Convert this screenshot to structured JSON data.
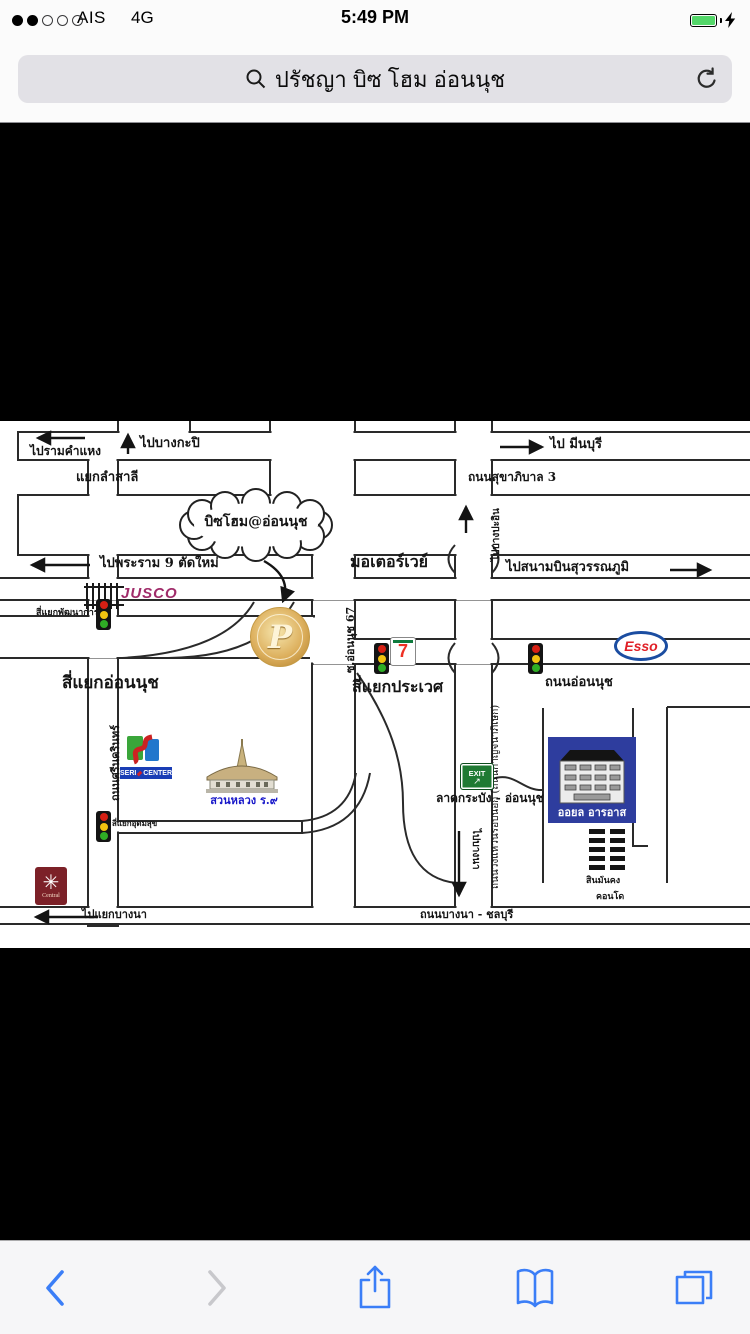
{
  "status_bar": {
    "carrier": "AIS",
    "network": "4G",
    "time": "5:49 PM"
  },
  "address_bar": {
    "query": "ปรัชญา บิซ โฮม อ่อนนุช"
  },
  "map": {
    "cloud_label": "บิซโฮม@อ่อนนุช",
    "coin_letter": "P",
    "directions": {
      "to_ramkhamhaeng": "ไปรามคำแหง",
      "to_bangkapi": "ไปบางกะปิ",
      "to_minburi": "ไป มีนบุรี",
      "to_rama9": "ไปพระราม 9 ตัดใหม่",
      "to_suvarnabhumi": "ไปสนามบินสุวรรณภูมิ",
      "to_bangpain": "ไปบางปะอิน",
      "to_bangna_junction": "ไปแยกบางนา",
      "to_bangna": "ไปบางนา"
    },
    "roads": {
      "sukhaphiban3": "ถนนสุขาภิบาล 3",
      "motorway": "มอเตอร์เวย์",
      "ring_road": "ถนนวงแหวนรอบนอก (ถนนกาญจนาภิเษก)",
      "soi_onnut67": "ซ.อ่อนนุช 67",
      "onnut_road": "ถนนอ่อนนุช",
      "srinakarin": "ถนนศรีนครินทร์",
      "ladkrabang_onnut": "ลาดกระบัง - อ่อนนุช",
      "bangna_chonburi": "ถนนบางนา - ชลบุรี"
    },
    "junctions": {
      "lam_sali": "แยกลำสาลี",
      "phatthanakan": "สี่แยกพัฒนาการ",
      "onnut": "สี่แยกอ่อนนุช",
      "prawet": "สี่แยกประเวศ",
      "udomsuk": "สี่แยกอุดมสุข"
    },
    "places": {
      "jusco": "JUSCO",
      "seven": "7",
      "esso": "Esso",
      "seri_line1": "SERI",
      "seri_line2": "CENTER",
      "park": "สวนหลวง ร.๙",
      "central": "Central",
      "exit": "EXIT",
      "oil_building": "ออยล อารอาส",
      "condo_line1": "สินมั่นคง",
      "condo_line2": "คอนโด"
    }
  }
}
